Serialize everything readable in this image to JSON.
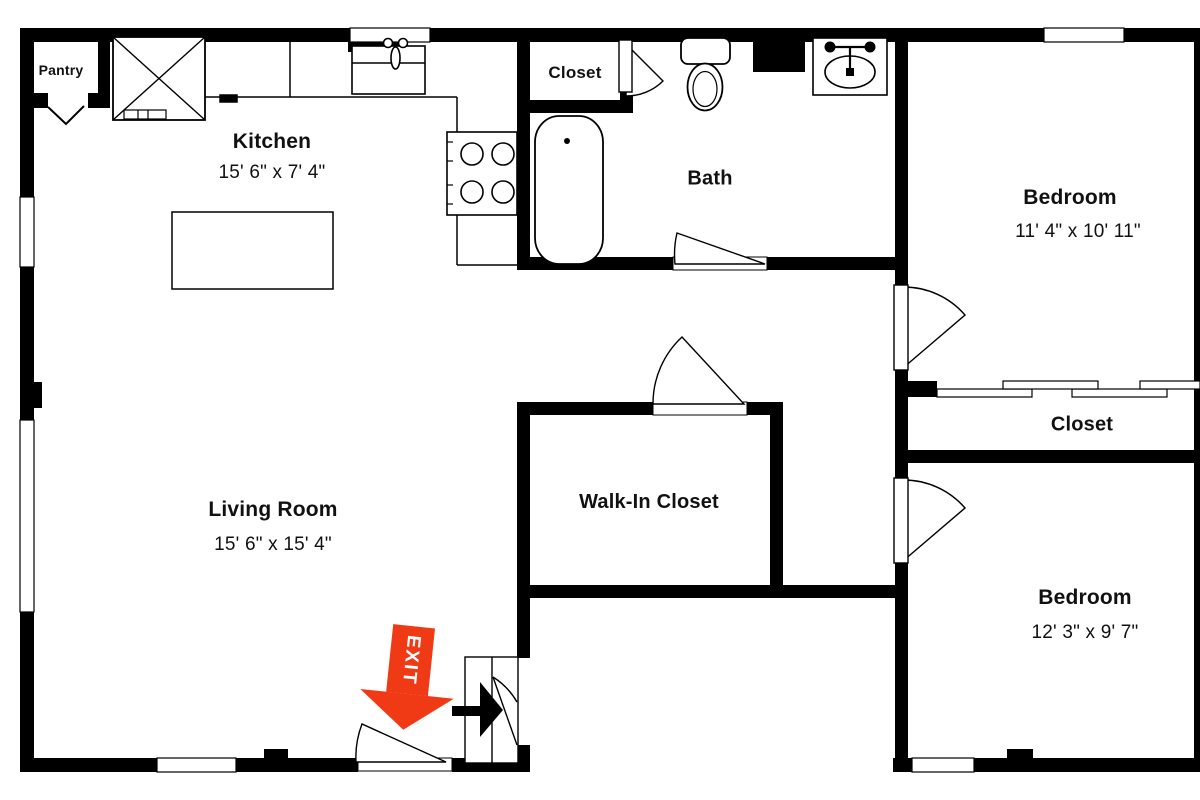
{
  "rooms": {
    "pantry": {
      "name": "Pantry"
    },
    "kitchen": {
      "name": "Kitchen",
      "dims": "15' 6\" x 7' 4\""
    },
    "bath_closet": {
      "name": "Closet"
    },
    "bath": {
      "name": "Bath"
    },
    "bedroom_top": {
      "name": "Bedroom",
      "dims": "11' 4\" x 10' 11\""
    },
    "living_room": {
      "name": "Living Room",
      "dims": "15' 6\" x 15' 4\""
    },
    "walk_in_closet": {
      "name": "Walk-In Closet"
    },
    "hall_closet": {
      "name": "Closet"
    },
    "bedroom_bottom": {
      "name": "Bedroom",
      "dims": "12' 3\" x 9' 7\""
    }
  },
  "annotations": {
    "exit_label": "EXIT"
  },
  "colors": {
    "wall": "#000000",
    "background": "#ffffff",
    "exit_arrow": "#f03a15",
    "text": "#111111"
  },
  "fixtures": [
    "refrigerator-icon",
    "kitchen-sink-icon",
    "stove-icon",
    "kitchen-island-icon",
    "bathtub-icon",
    "toilet-icon",
    "vanity-sink-icon",
    "bifold-door-icon",
    "sliding-door-icon",
    "door-swing-icon",
    "window-icon",
    "exit-arrow-icon",
    "entry-arrow-icon"
  ]
}
